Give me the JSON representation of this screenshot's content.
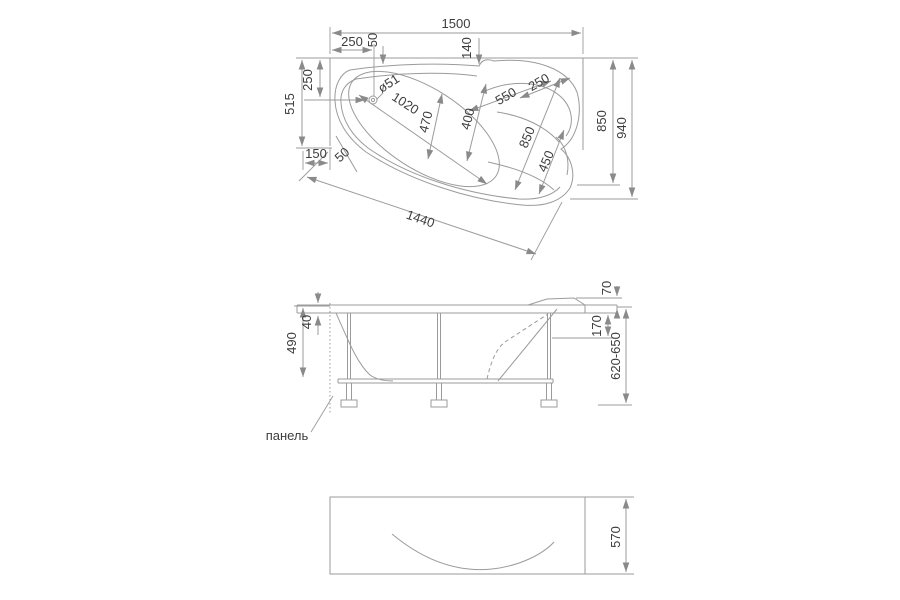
{
  "colors": {
    "background": "#ffffff",
    "line": "#9b9b9b",
    "text": "#3d3d3d"
  },
  "top_view": {
    "overall_width": "1500",
    "drain_x": "250",
    "rim_50": "50",
    "headrest_140": "140",
    "left_515": "515",
    "left_250": "250",
    "corner_150": "150",
    "diag_50": "50",
    "front_1440": "1440",
    "drain_dia": "ø51",
    "basin_1020": "1020",
    "basin_470": "470",
    "basin_400": "400",
    "head_550": "550",
    "head_250": "250",
    "inner_850": "850",
    "bulge_450": "450",
    "right_850": "850",
    "overall_940": "940"
  },
  "front_view": {
    "height_490": "490",
    "rim_40": "40",
    "headrest_70": "70",
    "step_170": "170",
    "floor_620_650": "620-650",
    "panel_label": "панель"
  },
  "panel_view": {
    "height_570": "570"
  }
}
